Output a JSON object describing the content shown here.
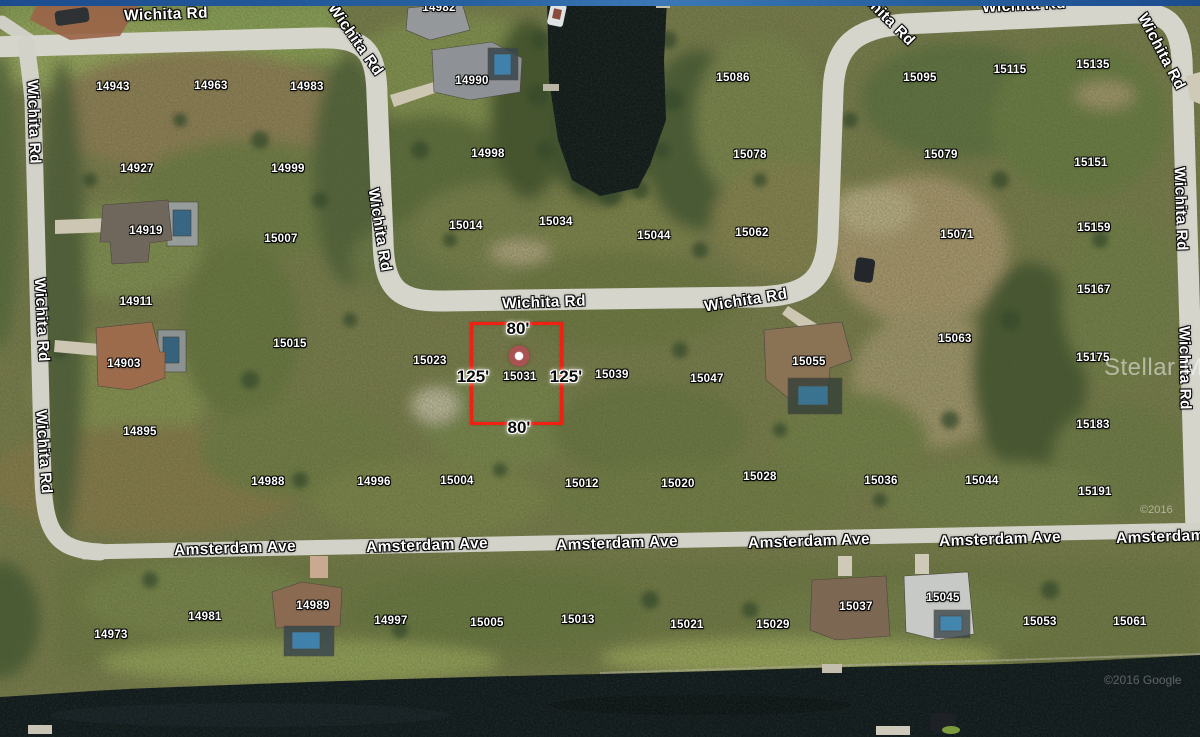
{
  "screen": {
    "kind": "satellite-parcel-map",
    "width": 1200,
    "height": 737
  },
  "colors": {
    "boundary_red": "#ee2113",
    "marker_red": "#a85252",
    "top_bar_blue": "#27619f",
    "road_gray": "#d5d5cc",
    "water_dark": "#10171c"
  },
  "roads": {
    "wichita": "Wichita Rd",
    "amsterdam": "Amsterdam Ave"
  },
  "road_labels": [
    {
      "text": "Wichita Rd",
      "x": 166,
      "y": 15,
      "r": -2
    },
    {
      "text": "Wichita Rd",
      "x": 355,
      "y": 40,
      "r": 55
    },
    {
      "text": "Wichita Rd",
      "x": 33,
      "y": 122,
      "r": 88
    },
    {
      "text": "Wichita Rd",
      "x": 41,
      "y": 320,
      "r": 87
    },
    {
      "text": "Wichita Rd",
      "x": 43,
      "y": 452,
      "r": 86
    },
    {
      "text": "Wichita Rd",
      "x": 379,
      "y": 230,
      "r": 81
    },
    {
      "text": "Wichita Rd",
      "x": 544,
      "y": 303,
      "r": -2
    },
    {
      "text": "Wichita Rd",
      "x": 746,
      "y": 301,
      "r": -9
    },
    {
      "text": "Wichita Rd",
      "x": 882,
      "y": 14,
      "r": 45
    },
    {
      "text": "Wichita Rd",
      "x": 1024,
      "y": 6,
      "r": -3
    },
    {
      "text": "Wichita Rd",
      "x": 1161,
      "y": 52,
      "r": 62
    },
    {
      "text": "Wichita Rd",
      "x": 1180,
      "y": 209,
      "r": 88
    },
    {
      "text": "Wichita Rd",
      "x": 1184,
      "y": 368,
      "r": 89
    },
    {
      "text": "Amsterdam Ave",
      "x": 235,
      "y": 549,
      "r": -2
    },
    {
      "text": "Amsterdam Ave",
      "x": 427,
      "y": 546,
      "r": -2
    },
    {
      "text": "Amsterdam Ave",
      "x": 617,
      "y": 544,
      "r": -2
    },
    {
      "text": "Amsterdam Ave",
      "x": 809,
      "y": 542,
      "r": -2
    },
    {
      "text": "Amsterdam Ave",
      "x": 1000,
      "y": 540,
      "r": -2
    },
    {
      "text": "Amsterdam Ave",
      "x": 1177,
      "y": 537,
      "r": -2
    }
  ],
  "parcel_labels": [
    {
      "text": "14943",
      "x": 113,
      "y": 87
    },
    {
      "text": "14963",
      "x": 211,
      "y": 86
    },
    {
      "text": "14983",
      "x": 307,
      "y": 87
    },
    {
      "text": "14927",
      "x": 137,
      "y": 169
    },
    {
      "text": "14999",
      "x": 288,
      "y": 169
    },
    {
      "text": "14919",
      "x": 146,
      "y": 231
    },
    {
      "text": "15007",
      "x": 281,
      "y": 239
    },
    {
      "text": "14911",
      "x": 136,
      "y": 302
    },
    {
      "text": "15015",
      "x": 290,
      "y": 344
    },
    {
      "text": "14903",
      "x": 124,
      "y": 364
    },
    {
      "text": "14895",
      "x": 140,
      "y": 432
    },
    {
      "text": "14982",
      "x": 439,
      "y": 8
    },
    {
      "text": "14990",
      "x": 472,
      "y": 81
    },
    {
      "text": "14998",
      "x": 488,
      "y": 154
    },
    {
      "text": "15014",
      "x": 466,
      "y": 226
    },
    {
      "text": "15034",
      "x": 556,
      "y": 222
    },
    {
      "text": "15044",
      "x": 654,
      "y": 236
    },
    {
      "text": "15062",
      "x": 752,
      "y": 233
    },
    {
      "text": "15078",
      "x": 750,
      "y": 155
    },
    {
      "text": "15086",
      "x": 733,
      "y": 78
    },
    {
      "text": "15095",
      "x": 920,
      "y": 78
    },
    {
      "text": "15115",
      "x": 1010,
      "y": 70
    },
    {
      "text": "15135",
      "x": 1093,
      "y": 65
    },
    {
      "text": "15079",
      "x": 941,
      "y": 155
    },
    {
      "text": "15151",
      "x": 1091,
      "y": 163
    },
    {
      "text": "15071",
      "x": 957,
      "y": 235
    },
    {
      "text": "15159",
      "x": 1094,
      "y": 228
    },
    {
      "text": "15167",
      "x": 1094,
      "y": 290
    },
    {
      "text": "15023",
      "x": 430,
      "y": 361
    },
    {
      "text": "15031",
      "x": 520,
      "y": 377
    },
    {
      "text": "15039",
      "x": 612,
      "y": 375
    },
    {
      "text": "15047",
      "x": 707,
      "y": 379
    },
    {
      "text": "15055",
      "x": 809,
      "y": 362
    },
    {
      "text": "15063",
      "x": 955,
      "y": 339
    },
    {
      "text": "15175",
      "x": 1093,
      "y": 358
    },
    {
      "text": "15183",
      "x": 1093,
      "y": 425
    },
    {
      "text": "15191",
      "x": 1095,
      "y": 492
    },
    {
      "text": "14988",
      "x": 268,
      "y": 482
    },
    {
      "text": "14996",
      "x": 374,
      "y": 482
    },
    {
      "text": "15004",
      "x": 457,
      "y": 481
    },
    {
      "text": "15012",
      "x": 582,
      "y": 484
    },
    {
      "text": "15020",
      "x": 678,
      "y": 484
    },
    {
      "text": "15028",
      "x": 760,
      "y": 477
    },
    {
      "text": "15036",
      "x": 881,
      "y": 481
    },
    {
      "text": "15044",
      "x": 982,
      "y": 481
    },
    {
      "text": "14973",
      "x": 111,
      "y": 635
    },
    {
      "text": "14981",
      "x": 205,
      "y": 617
    },
    {
      "text": "14989",
      "x": 313,
      "y": 606
    },
    {
      "text": "14997",
      "x": 391,
      "y": 621
    },
    {
      "text": "15005",
      "x": 487,
      "y": 623
    },
    {
      "text": "15013",
      "x": 578,
      "y": 620
    },
    {
      "text": "15021",
      "x": 687,
      "y": 625
    },
    {
      "text": "15029",
      "x": 773,
      "y": 625
    },
    {
      "text": "15037",
      "x": 856,
      "y": 607
    },
    {
      "text": "15045",
      "x": 943,
      "y": 598
    },
    {
      "text": "15053",
      "x": 1040,
      "y": 622
    },
    {
      "text": "15061",
      "x": 1130,
      "y": 622
    }
  ],
  "selected_parcel": {
    "number": "15031",
    "frontage": "80'",
    "depth": "125'",
    "boundary": {
      "x": 470,
      "y": 322,
      "width": 93,
      "height": 103
    },
    "marker": {
      "x": 519,
      "y": 356
    },
    "dimension_labels": [
      {
        "text": "80'",
        "x": 518,
        "y": 329
      },
      {
        "text": "80'",
        "x": 519,
        "y": 428
      },
      {
        "text": "125'",
        "x": 473,
        "y": 377
      },
      {
        "text": "125'",
        "x": 566,
        "y": 377
      }
    ]
  },
  "watermarks": {
    "mls": {
      "text": "Stellar MLS"
    },
    "imagery_year": {
      "text": "©2016"
    },
    "imagery_credit": {
      "text": "©2016 Google"
    }
  }
}
